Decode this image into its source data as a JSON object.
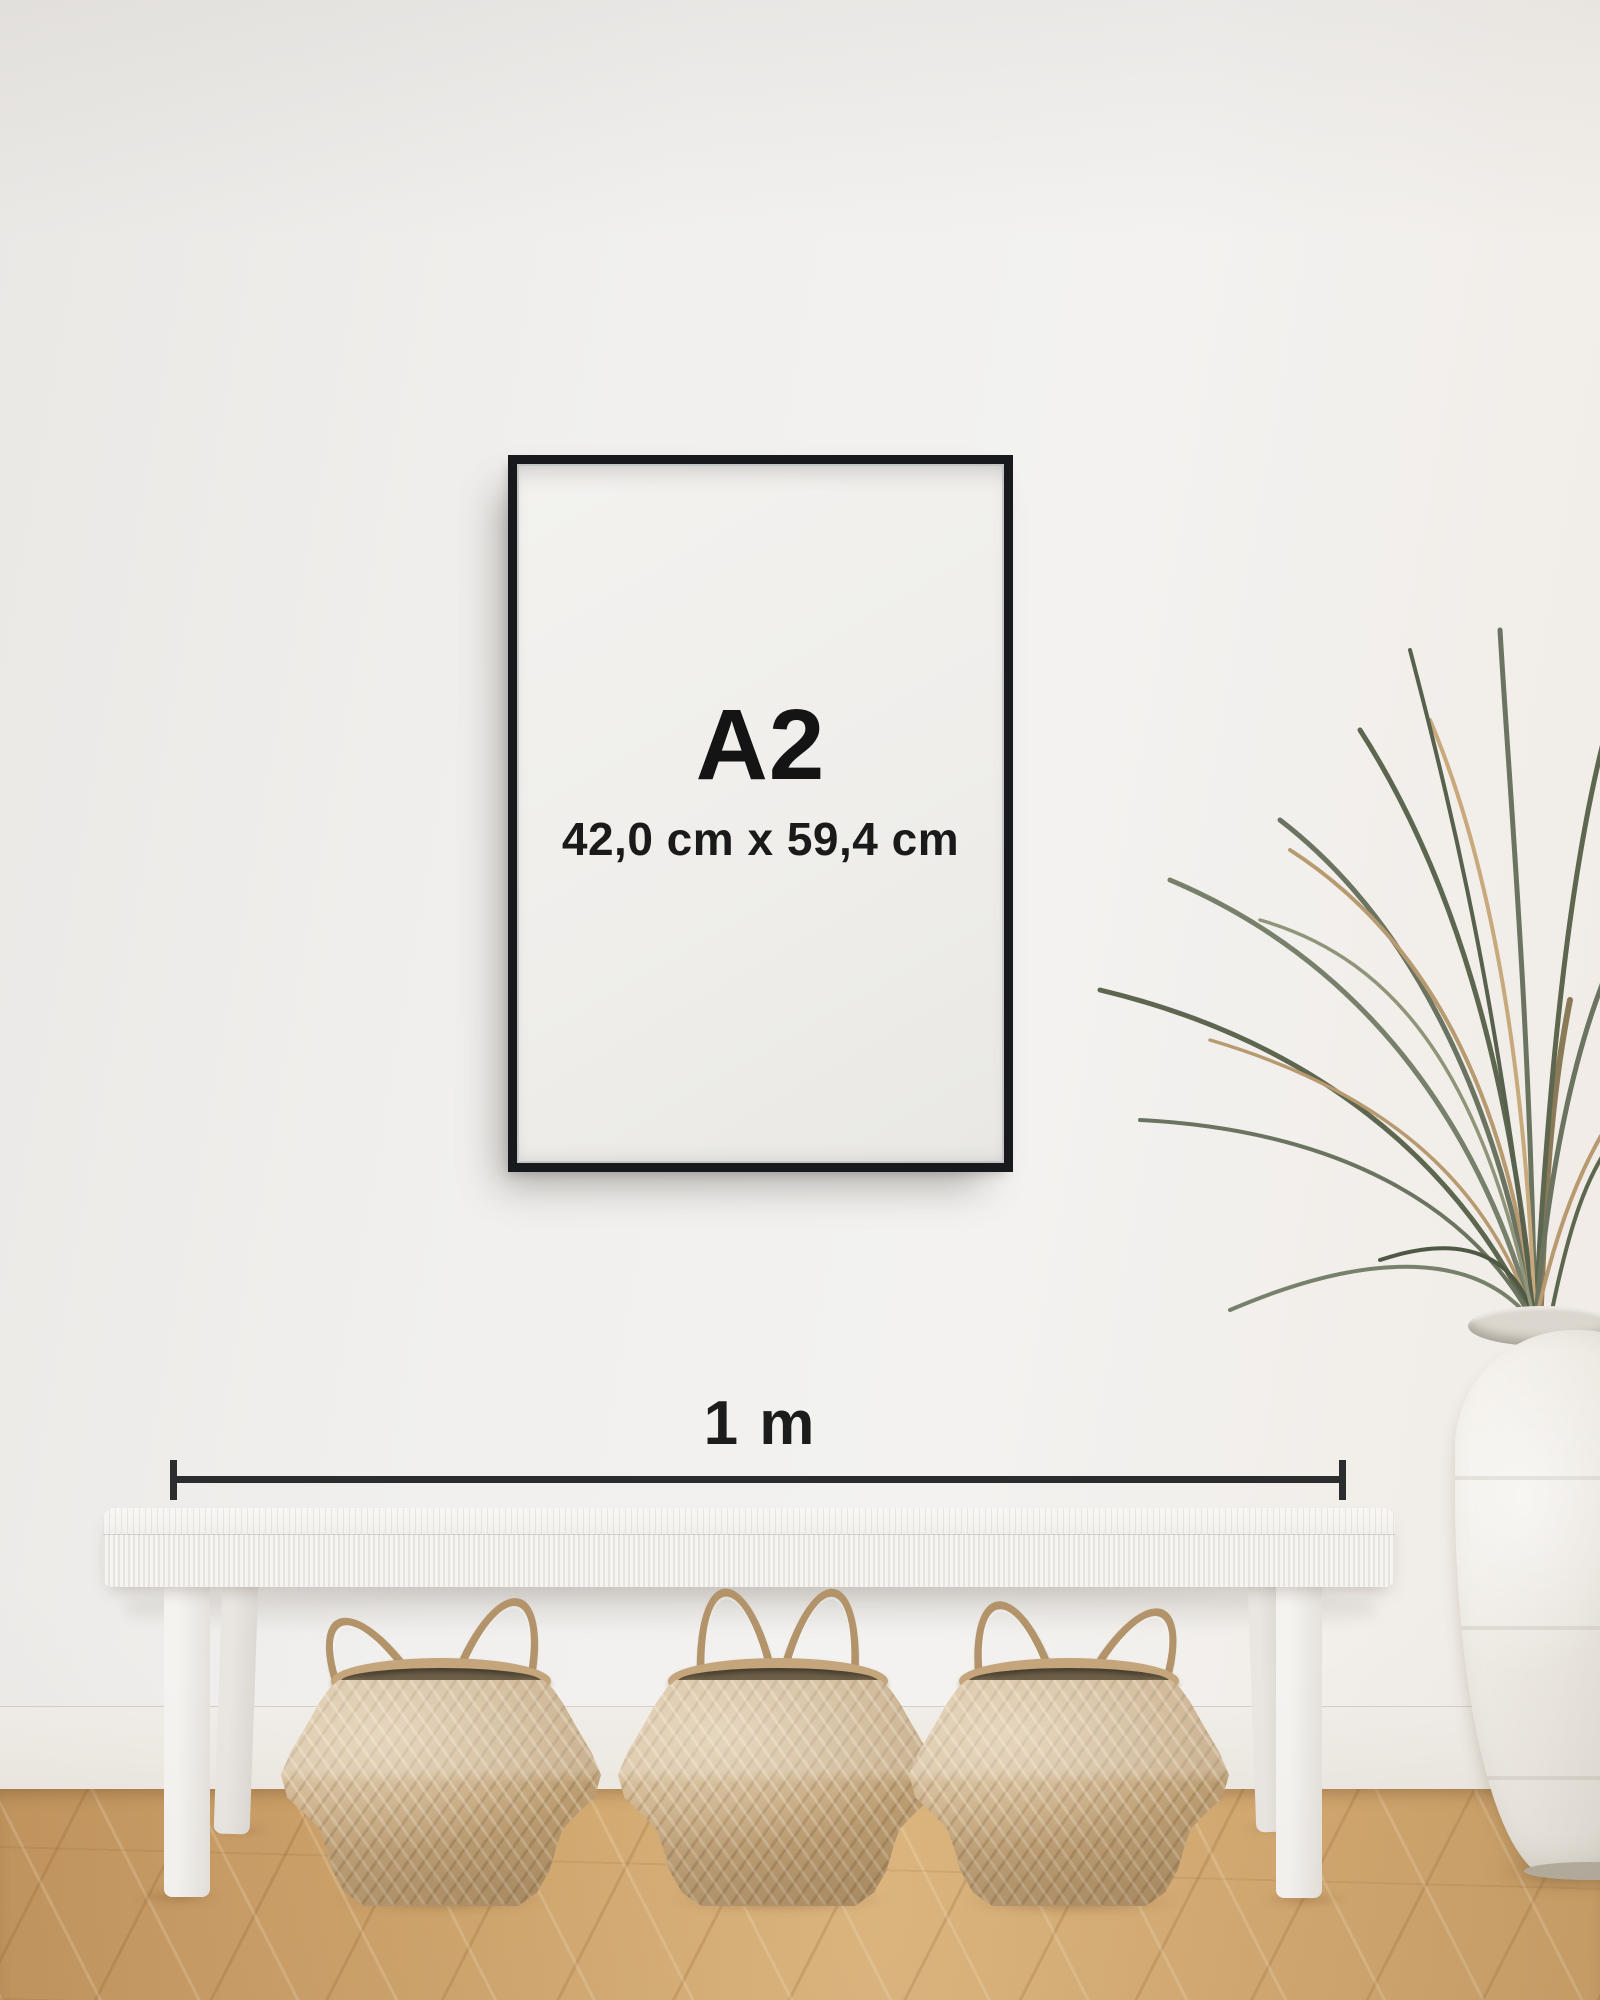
{
  "scene": {
    "type": "product-size-mockup",
    "description": "Black A2 frame mockup on a wall above a white woven bench with three seagrass baskets, a dried palm in a white vase, wooden floor, with a 1 metre scale reference"
  },
  "poster": {
    "size_label": "A2",
    "dimensions_label": "42,0 cm x 59,4 cm"
  },
  "scale_indicator": {
    "label": "1 m"
  },
  "objects": [
    "picture-frame",
    "bench",
    "basket",
    "basket",
    "basket",
    "palm-plant",
    "vase"
  ],
  "colors": {
    "wall": "#f0efed",
    "baseboard": "#eeeae4",
    "floor_wood": "#cfa46c",
    "frame": "#17191c",
    "poster_paper": "#f0efec",
    "text": "#141414",
    "measure_line": "#2b2c2d",
    "bench": "#f4f2ee",
    "basket": "#c7a87e",
    "basket_interior": "#6e6048",
    "plant_green": "#66705b",
    "plant_dried": "#bb9d72",
    "vase": "#ece8e1"
  }
}
